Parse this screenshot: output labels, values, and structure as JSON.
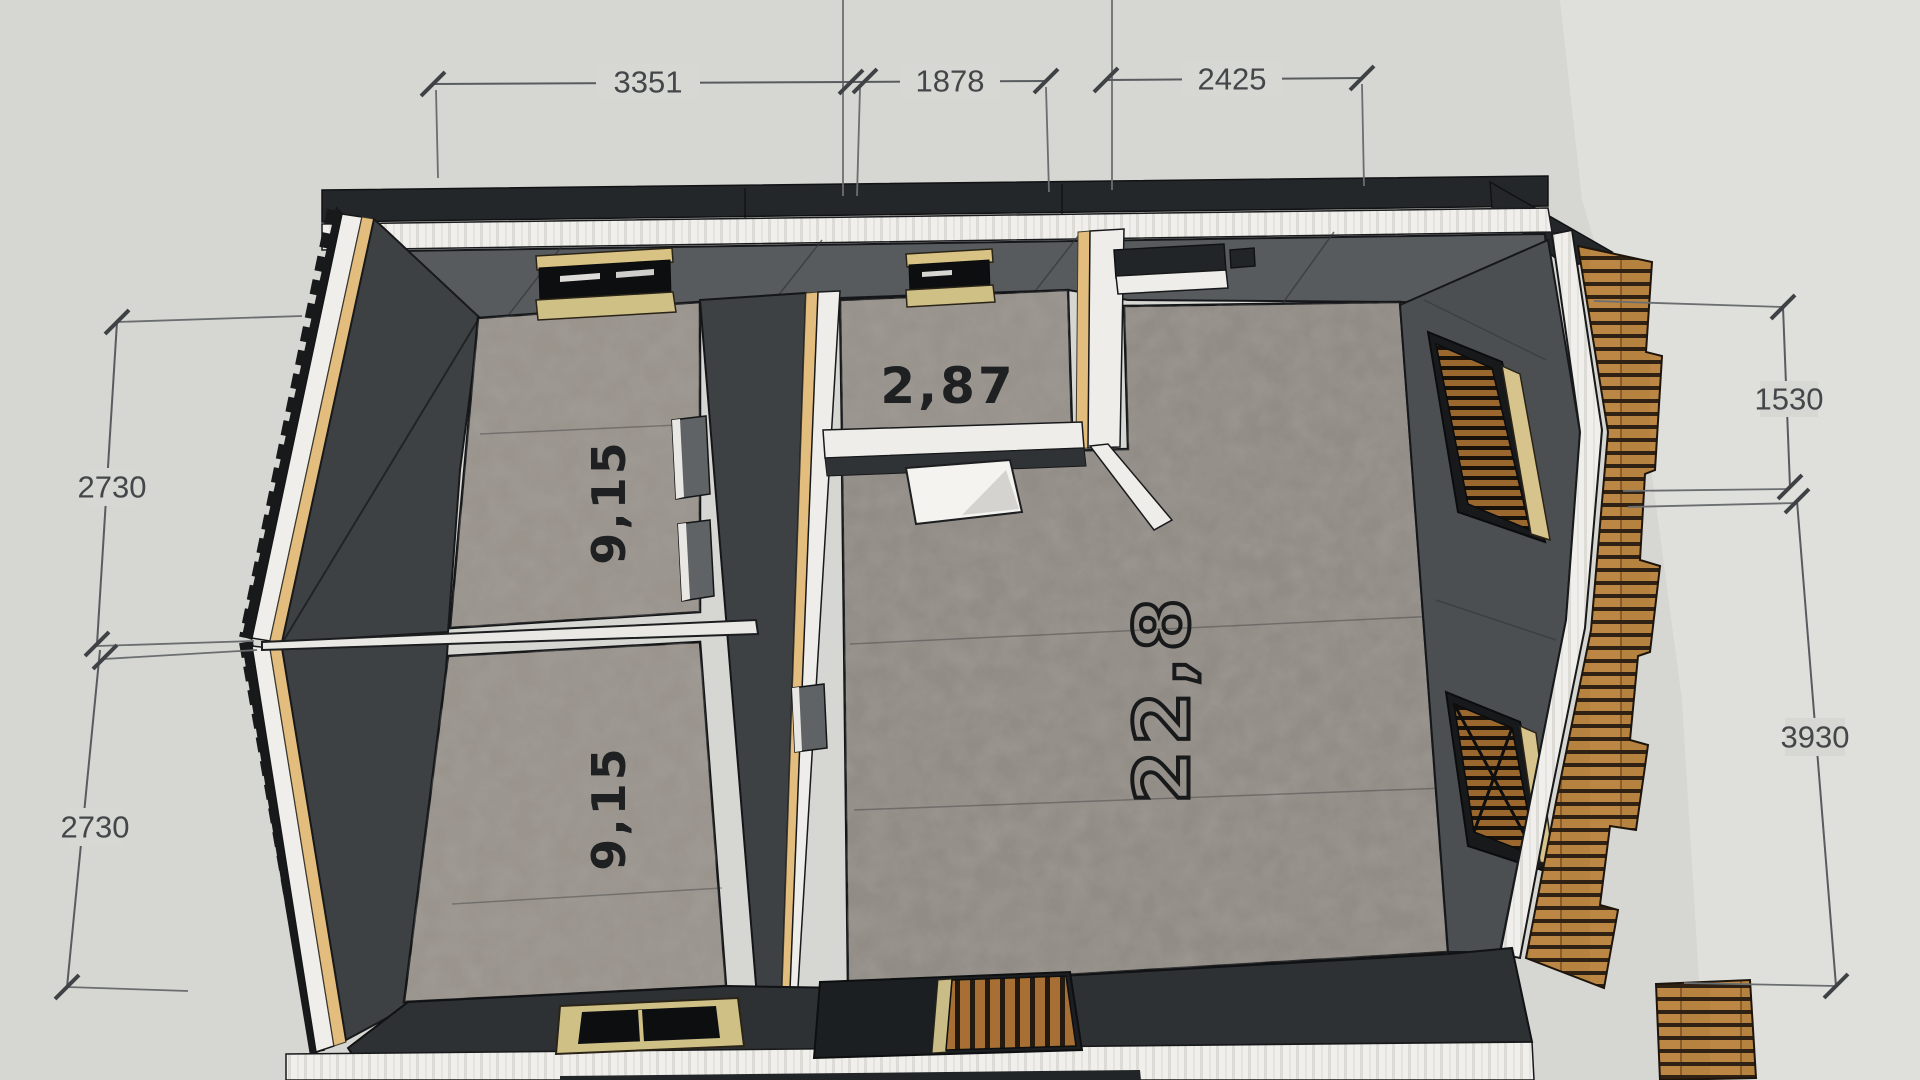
{
  "scene": {
    "description": "SketchUp-style top-down cutaway floor plan of a small house with dimensions in millimetres and room areas in square metres",
    "background_color": "#d6d6d2",
    "colors": {
      "roof": "#24272a",
      "fascia": "#f0efeb",
      "wall_band": "#575b5e",
      "wall_dark": "#4b4f52",
      "roof_inner": "#3e4144",
      "floor": "#9a948d",
      "floor_big": "#928c86",
      "floor_hall": "#98928c",
      "stud_wood": "#e3bd7d",
      "deck_wood": "#b5823f",
      "window_glass": "#0c0e10",
      "sill_khaki": "#cfc086",
      "dimension_text": "#44474a",
      "outline": "#141618"
    },
    "dimensions": {
      "top": [
        {
          "label": "3351"
        },
        {
          "label": "1878"
        },
        {
          "label": "2425"
        }
      ],
      "left": [
        {
          "label": "2730"
        },
        {
          "label": "2730"
        }
      ],
      "right": [
        {
          "label": "1530"
        },
        {
          "label": "3930"
        }
      ]
    },
    "rooms": [
      {
        "id": "upper-left-room",
        "area": "9,15"
      },
      {
        "id": "lower-left-room",
        "area": "9,15"
      },
      {
        "id": "hallway",
        "area": "2,87"
      },
      {
        "id": "living-room",
        "area": "22,8"
      }
    ]
  }
}
